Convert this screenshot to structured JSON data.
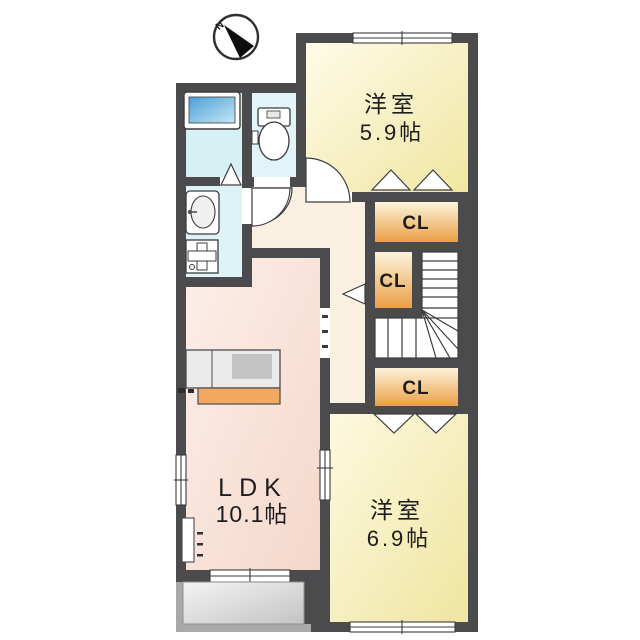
{
  "compass": {
    "north_label": "N"
  },
  "rooms": {
    "bedroom_north": {
      "label": "洋室",
      "area": "5.9帖"
    },
    "bedroom_south": {
      "label": "洋室",
      "area": "6.9帖"
    },
    "ldk": {
      "label": "LDK",
      "area": "10.1帖"
    },
    "closet_north": {
      "label": "CL"
    },
    "closet_middle": {
      "label": "CL"
    },
    "closet_south": {
      "label": "CL"
    }
  },
  "fixtures": [
    "north-arrow",
    "bathtub",
    "toilet",
    "vanity-sink",
    "washing-machine-pan",
    "kitchen-counter",
    "refrigerator-space",
    "stairs",
    "balcony"
  ],
  "colors": {
    "wall": "#4B4B4E",
    "room_yellow": "#F5ECAF",
    "room_pink": "#F9E2D8",
    "hall_cream": "#FAF0E1",
    "water_blue": "#D8F1F4",
    "closet_orange": "#ECA14A",
    "closet_cream": "#FCF3DC",
    "bathtub_blue": "#4D9FD8",
    "balcony_gray": "#D9D9D9"
  }
}
